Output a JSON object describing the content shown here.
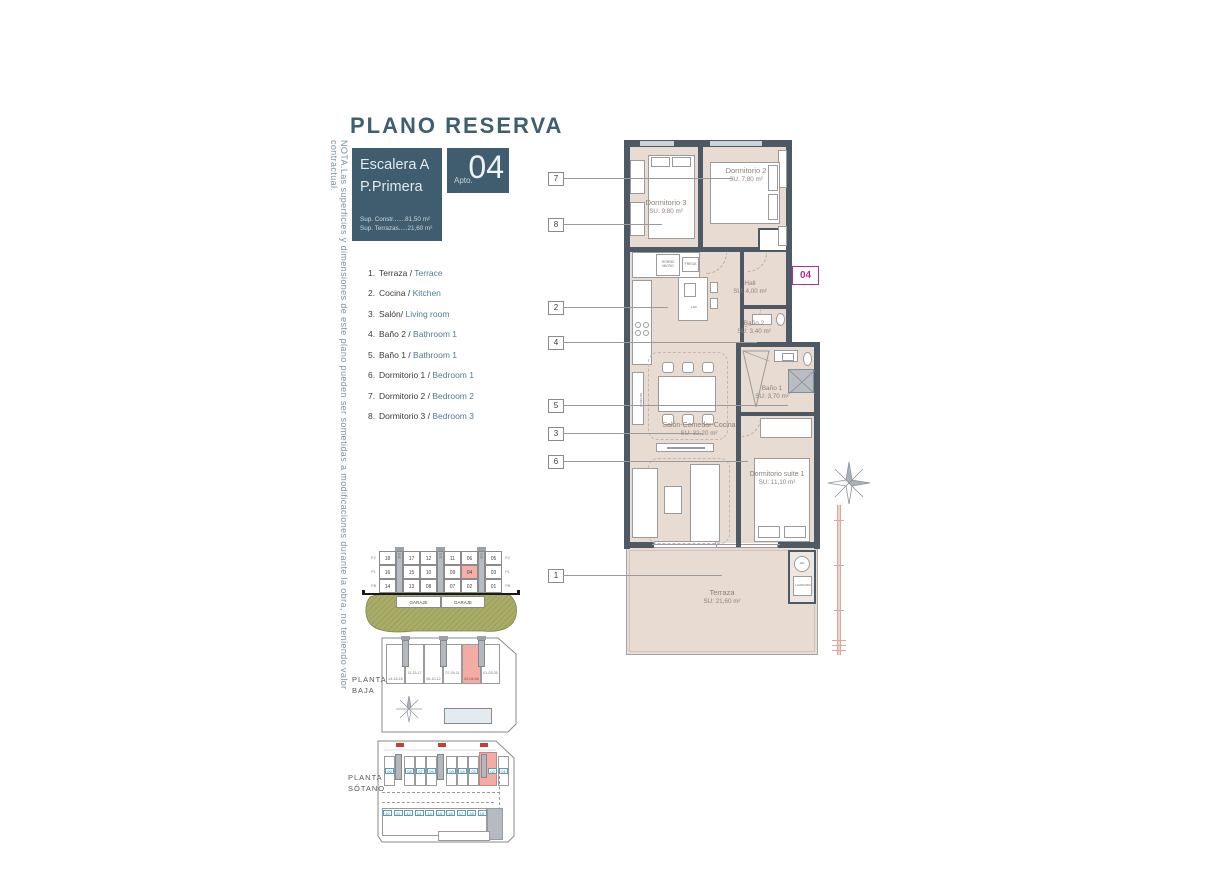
{
  "title": "PLANO RESERVA",
  "note_vertical": "NOTA.Las superficies y dimensiones de este plano pueden ser sometidas a modificaciones durante la obra, no teniendo valor contractual.",
  "header": {
    "escalera": "Escalera A",
    "planta": "P.Primera",
    "sup_constr": "Sup. Constr.......81,50 m²",
    "sup_terrazas": "Sup. Terrazas.....21,60 m²",
    "apto_label": "Apto.",
    "apto_number": "04"
  },
  "legend": {
    "items": [
      {
        "num": "1.",
        "es": "Terraza /",
        "en": "Terrace"
      },
      {
        "num": "2.",
        "es": "Cocina /",
        "en": "Kitchen"
      },
      {
        "num": "3.",
        "es": "Salón/",
        "en": "Living room"
      },
      {
        "num": "4.",
        "es": "Baño 2 /",
        "en": "Bathroom 1"
      },
      {
        "num": "5.",
        "es": "Baño 1 /",
        "en": "Bathroom 1"
      },
      {
        "num": "6.",
        "es": "Dormitorio 1 /",
        "en": "Bedroom 1"
      },
      {
        "num": "7.",
        "es": "Dormitorio 2 /",
        "en": "Bedroom 2"
      },
      {
        "num": "8.",
        "es": "Dormitorio 3 /",
        "en": "Bedroom 3"
      }
    ]
  },
  "plan": {
    "badge": "04",
    "callouts": [
      "7",
      "8",
      "2",
      "4",
      "5",
      "3",
      "6",
      "1"
    ],
    "rooms": {
      "dorm3": {
        "name": "Dormitorio 3",
        "area": "SU: 9,80 m²"
      },
      "dorm2": {
        "name": "Dormitorio 2",
        "area": "SU: 7,80 m²"
      },
      "hall": {
        "name": "Hall",
        "area": "SU: 4,00 m²"
      },
      "bano2": {
        "name": "Baño 2",
        "area": "SU: 3,40 m²"
      },
      "bano1": {
        "name": "Baño 1",
        "area": "SU: 3,70 m²"
      },
      "salon": {
        "name": "Salón-Comedor-Cocina",
        "area": "SU: 32,20 m²"
      },
      "suite": {
        "name": "Dormitorio suite 1",
        "area": "SU: 11,10 m²"
      },
      "terraza": {
        "name": "Terraza",
        "area": "SU: 21,60 m²"
      }
    },
    "fixtures": {
      "horno": "HORNO MICRO",
      "frega": "FREGA",
      "nevera": "NEVERA",
      "lav": "LAV",
      "aa": "AA",
      "lavadora": "LAVADORA"
    }
  },
  "section": {
    "esc": "ESC",
    "rows": [
      [
        "18",
        "17",
        "12",
        "11",
        "06",
        "05"
      ],
      [
        "16",
        "15",
        "10",
        "09",
        "04",
        "03"
      ],
      [
        "14",
        "13",
        "08",
        "07",
        "02",
        "01"
      ]
    ],
    "levels": [
      "P2",
      "P1",
      "PB"
    ],
    "garaje_left": "GARAJE",
    "garaje_right": "GARAJE"
  },
  "planta_baja": {
    "label_line1": "PLANTA",
    "label_line2": "BAJA",
    "slots": [
      "14-16-18",
      "13-15-17",
      "08-10-12",
      "07-09-11",
      "02-04-06",
      "01-03-05"
    ]
  },
  "planta_sotano": {
    "label_line1": "PLANTA",
    "label_line2": "SÓTANO",
    "top_row": [
      "09",
      "08",
      "07",
      "06",
      "05",
      "04",
      "03",
      "02",
      "01"
    ],
    "bottom_row": [
      "10",
      "11",
      "12",
      "13",
      "14",
      "15",
      "16",
      "17",
      "18",
      "19"
    ]
  },
  "colors": {
    "teal_dark": "#3f5d6e",
    "magenta": "#bb2a8f",
    "highlight_pink": "#f2aca4",
    "wall": "#4d5a66",
    "floor": "#e8dcd2"
  }
}
